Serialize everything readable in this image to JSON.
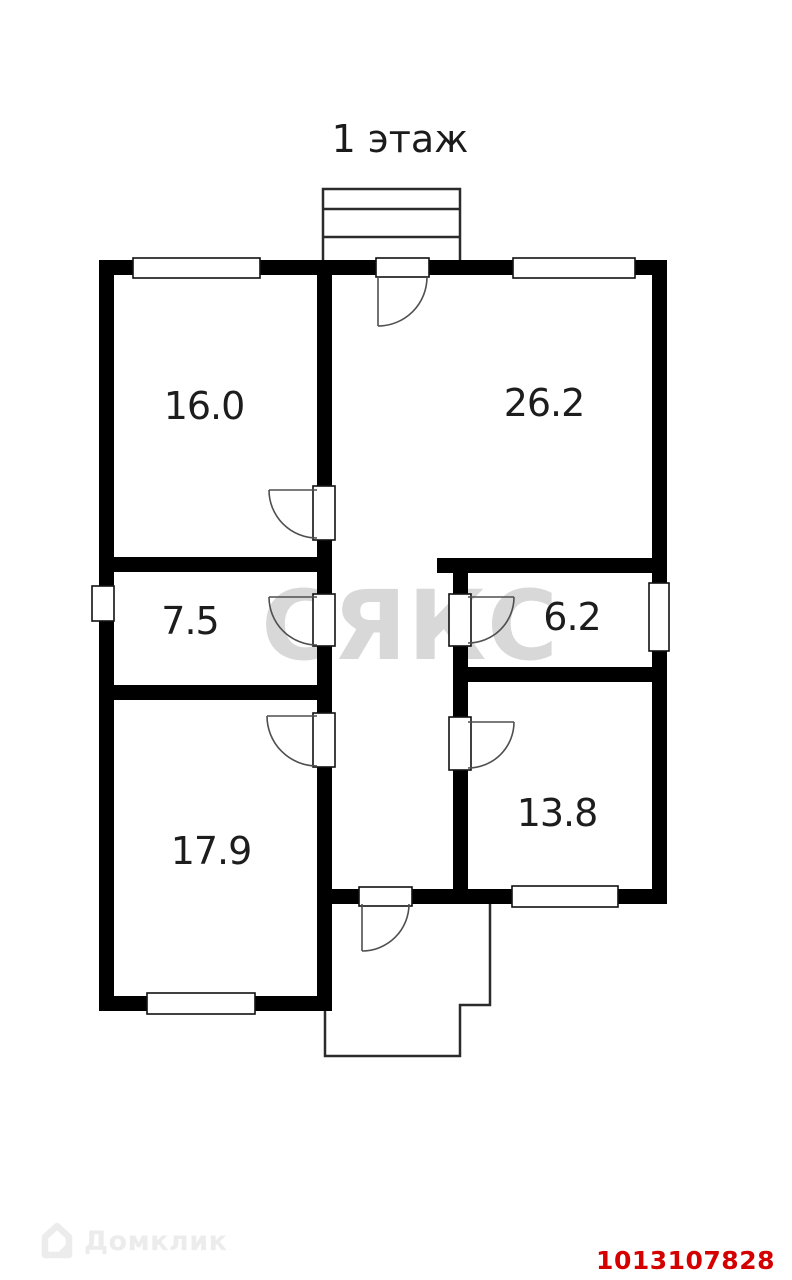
{
  "title": {
    "text": "1 этаж"
  },
  "plan": {
    "rooms": [
      {
        "name": "room-top-left",
        "label": "16.0"
      },
      {
        "name": "room-top-right",
        "label": "26.2"
      },
      {
        "name": "room-middle-left",
        "label": "7.5"
      },
      {
        "name": "room-middle-right",
        "label": "6.2"
      },
      {
        "name": "room-bottom-left",
        "label": "17.9"
      },
      {
        "name": "room-bottom-right",
        "label": "13.8"
      }
    ],
    "wall_color": "#000000",
    "door_arc_color": "#4f4f4f",
    "thin_outline_color": "#2b2b2b"
  },
  "watermark": {
    "text": "СЯКС",
    "color": "#d8d8d8"
  },
  "footer": {
    "brand_name": "Домклик",
    "brand_color": "#ececec",
    "listing_id": "1013107828",
    "listing_id_color": "#d40000"
  }
}
